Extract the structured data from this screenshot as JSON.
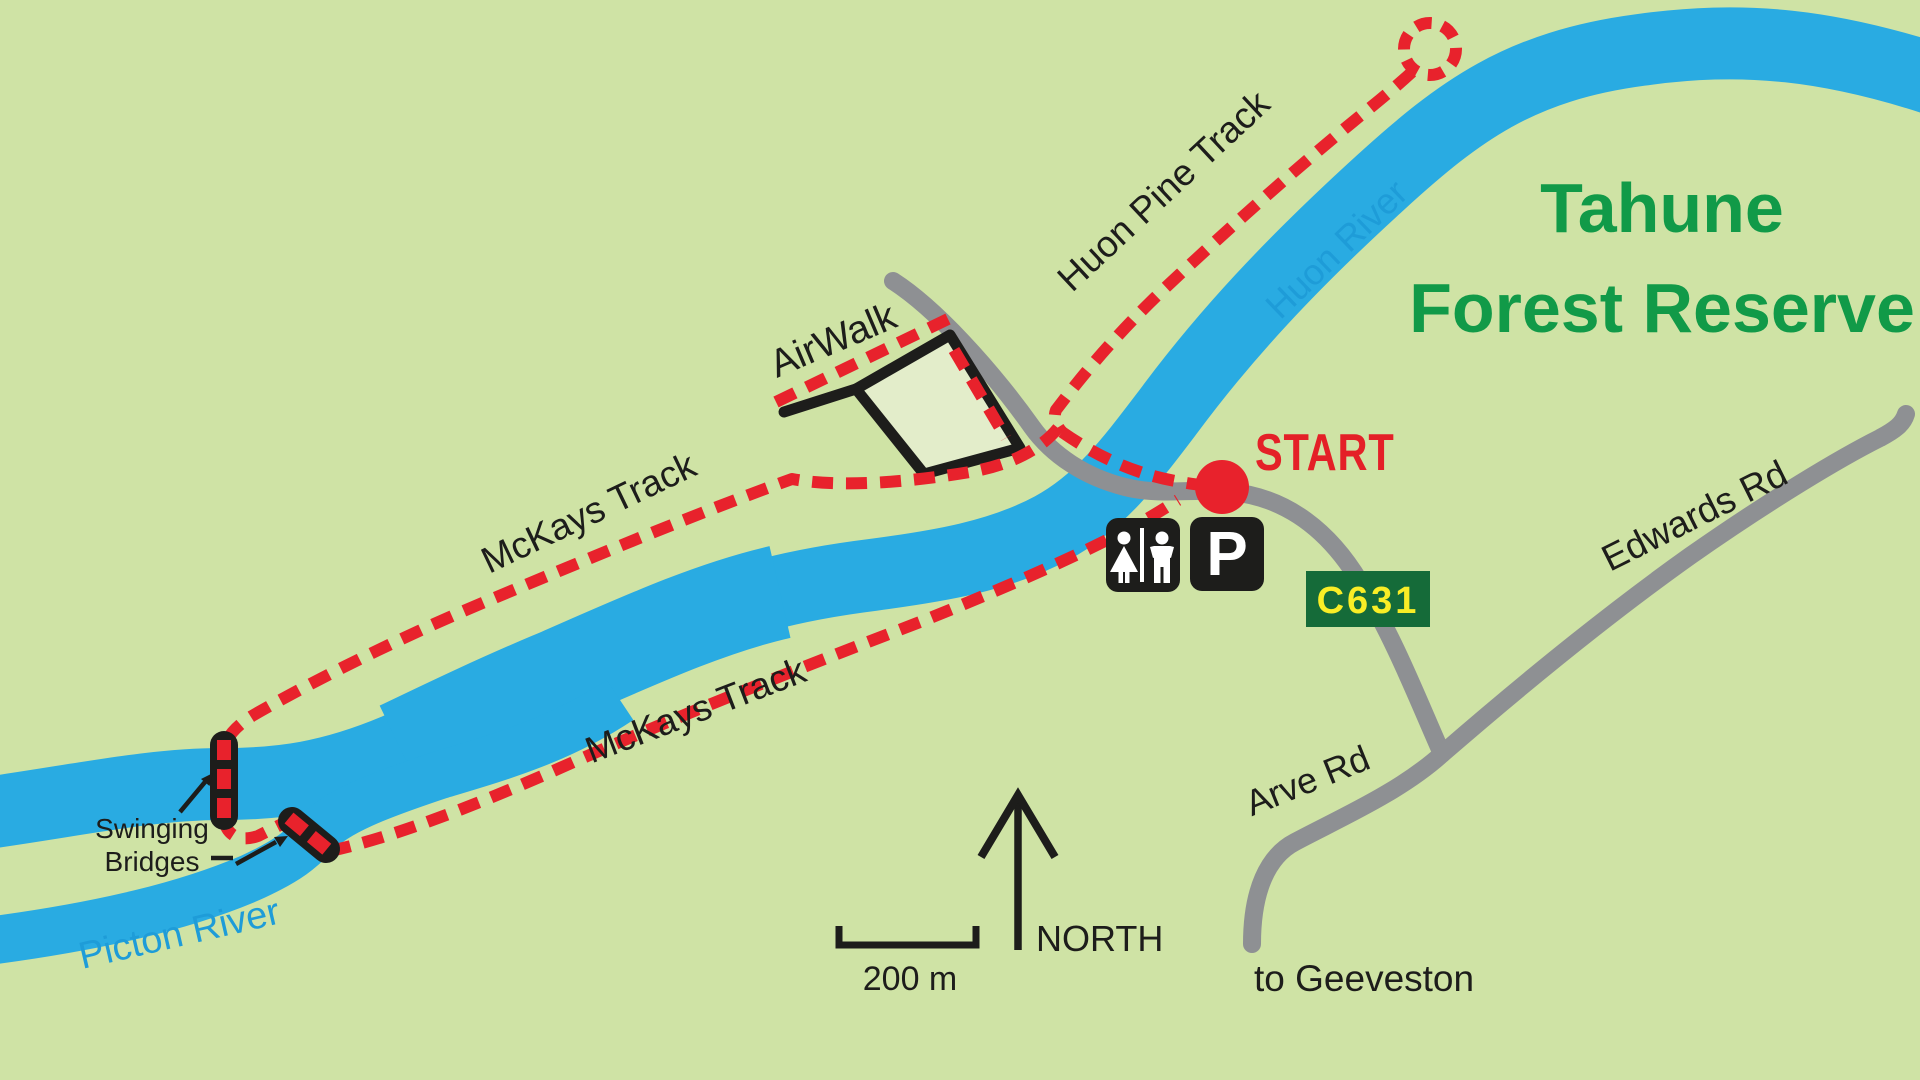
{
  "map": {
    "title": {
      "line1": "Tahune",
      "line2": "Forest Reserve"
    },
    "labels": {
      "huon_pine_track": "Huon Pine Track",
      "huon_river": "Huon River",
      "airwalk": "AirWalk",
      "mckays_track_upper": "McKays Track",
      "mckays_track_lower": "McKays Track",
      "start": "START",
      "swinging_bridges_line1": "Swinging",
      "swinging_bridges_line2": "Bridges",
      "picton_river": "Picton River",
      "arve_rd": "Arve Rd",
      "edwards_rd": "Edwards Rd",
      "to_geeveston": "to Geeveston",
      "road_sign_code": "C631",
      "parking_symbol": "P",
      "north": "NORTH",
      "scale_bar": "200 m"
    },
    "colors": {
      "background": "#cfe3a5",
      "river_blue": "#29abe2",
      "river_label_blue": "#1e9cd8",
      "road_gray": "#8e9093",
      "track_red": "#e8222c",
      "title_green": "#119a48",
      "sign_green": "#156b39",
      "sign_yellow": "#f9ed26",
      "map_black": "#1d1d1b",
      "airwalk_fill": "#e3edca",
      "start_red": "#e42027"
    }
  }
}
